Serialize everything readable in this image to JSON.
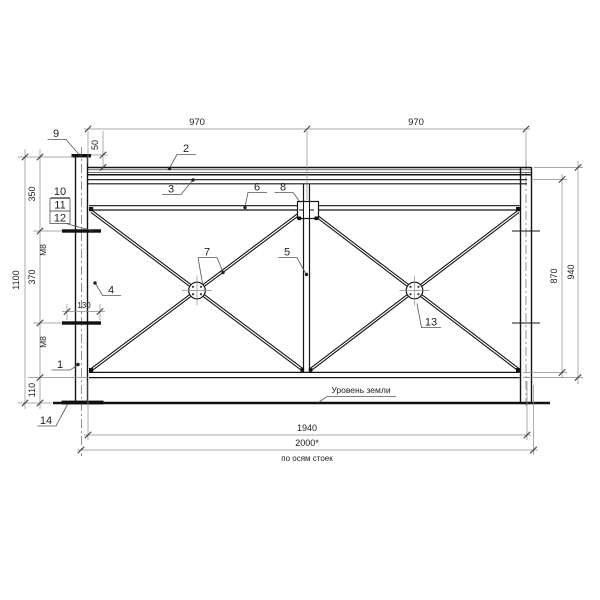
{
  "drawing": {
    "dims": {
      "span_left": "970",
      "span_right": "970",
      "top_offset": "50",
      "upper_segment": "350",
      "middle_segment": "370",
      "lower_segment": "110",
      "total_height": "1100",
      "bolt_length": "130",
      "bolt_upper": "M8",
      "bolt_lower": "M8",
      "panel_height": "870",
      "frame_height": "940",
      "rail_length": "1940",
      "post_spacing": "2000*"
    },
    "notes": {
      "ground_level": "Уровень земли",
      "post_axes": "по осям стоек"
    },
    "callouts": {
      "n1": "1",
      "n2": "2",
      "n3": "3",
      "n4": "4",
      "n5": "5",
      "n6": "6",
      "n7": "7",
      "n8": "8",
      "n9": "9",
      "n10": "10",
      "n11": "11",
      "n12": "12",
      "n13": "13",
      "n14": "14"
    }
  }
}
